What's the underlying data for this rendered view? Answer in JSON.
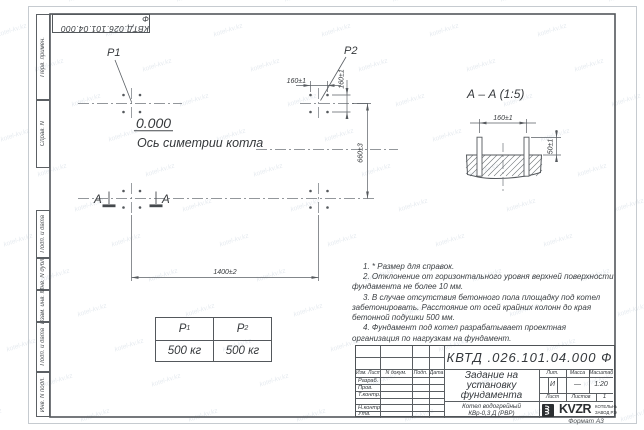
{
  "sheet": {
    "corner_doc_number": "КВТД.026.101.04.000 Ф",
    "format_label": "Формат А3",
    "side_labels": [
      "Перв. примен.",
      "Справ. N",
      "Подп. и дата",
      "Инв. N дубл.",
      "Взам. инв. N",
      "Подп. и дата",
      "Инв. N подл."
    ]
  },
  "plan": {
    "p1": "P1",
    "p2": "P2",
    "level": "0.000",
    "axis": "Ось симетрии котла",
    "section_letter_left": "А",
    "section_letter_right": "А",
    "dim_160_h": "160±1",
    "dim_160_v": "160±1",
    "dim_660": "660±3",
    "dim_1400": "1400±2"
  },
  "section": {
    "title": "А – А (1:5)",
    "dim_160": "160±1",
    "dim_50": "50±1"
  },
  "loads": {
    "h1": {
      "base": "P",
      "sub": "1"
    },
    "h2": {
      "base": "P",
      "sub": "2"
    },
    "v1": "500 кг",
    "v2": "500 кг"
  },
  "notes": [
    "1. * Размер для справок.",
    "2. Отклонение от горизонтального уровня верхней поверхности фундамента не более 10 мм.",
    "3. В случае отсутствия бетонного пола площадку под котел забетонировать. Расстояние от осей крайних колонн до края бетонной подушки 500 мм.",
    "4. Фундамент под котел разрабатывает проектная организация по нагрузкам на фундамент."
  ],
  "title_block": {
    "doc_number": "КВТД .026.101.04.000 Ф",
    "title_l1": "Задание на",
    "title_l2": "установку",
    "title_l3": "фундамента",
    "product_l1": "Котел водогрейный",
    "product_l2": "КВр-0,3 Д (РВР)",
    "col_izm": "Изм. Лист",
    "col_doc": "N докум.",
    "col_podp": "Подп.",
    "col_data": "Дата",
    "row_razrab": "Разраб.",
    "row_prov": "Пров.",
    "row_tkontr": "Т.контр.",
    "row_nkontr": "Н.контр.",
    "row_utv": "Утв.",
    "lit": "Лит.",
    "massa": "Масса",
    "masshtab": "Масштаб",
    "lit_val": "И",
    "massa_val": "—",
    "masshtab_val": "1:20",
    "list": "Лист",
    "listov": "Листов",
    "listov_val": "1",
    "logo_text": "KVZR",
    "logo_sub1": "КОТЕЛЬНЫЙ",
    "logo_sub2": "ЗАВОД РЭП"
  },
  "watermark": {
    "text": "kotel-kv.kz"
  }
}
